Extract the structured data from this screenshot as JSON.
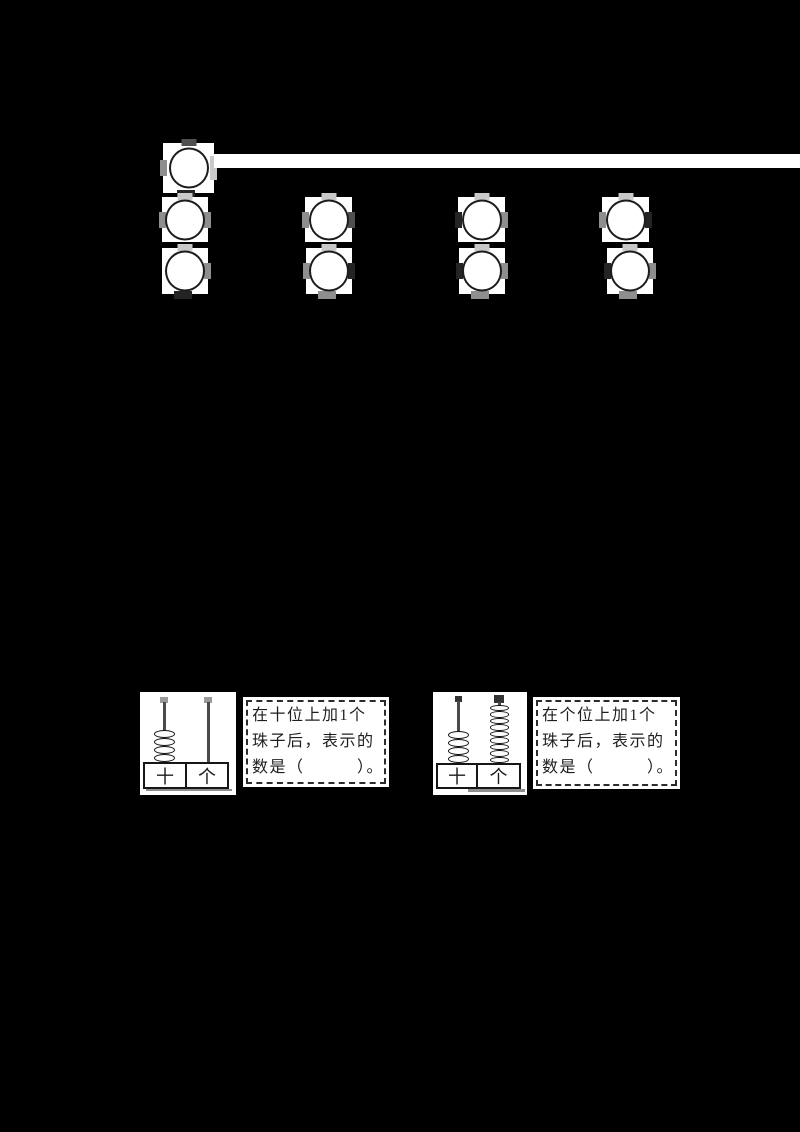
{
  "colors": {
    "background": "#000000",
    "paper": "#ffffff",
    "ink": "#1c1c1c"
  },
  "circles_section": {
    "description": "empty-circles",
    "rows": [
      {
        "name": "row-1",
        "circle_count": 1
      },
      {
        "name": "row-2",
        "circle_count": 4
      },
      {
        "name": "row-3",
        "circle_count": 4
      }
    ]
  },
  "abacus_exercises": [
    {
      "place_labels": {
        "tens": "十",
        "ones": "个"
      },
      "beads": {
        "tens": 4,
        "ones": 0
      },
      "prompt_lines": [
        "在十位上加1个",
        "珠子后，表示的",
        "数是（　　　）。"
      ]
    },
    {
      "place_labels": {
        "tens": "十",
        "ones": "个"
      },
      "beads": {
        "tens": 4,
        "ones": 9
      },
      "prompt_lines": [
        "在个位上加1个",
        "珠子后，表示的",
        "数是（　　　）。"
      ]
    }
  ]
}
